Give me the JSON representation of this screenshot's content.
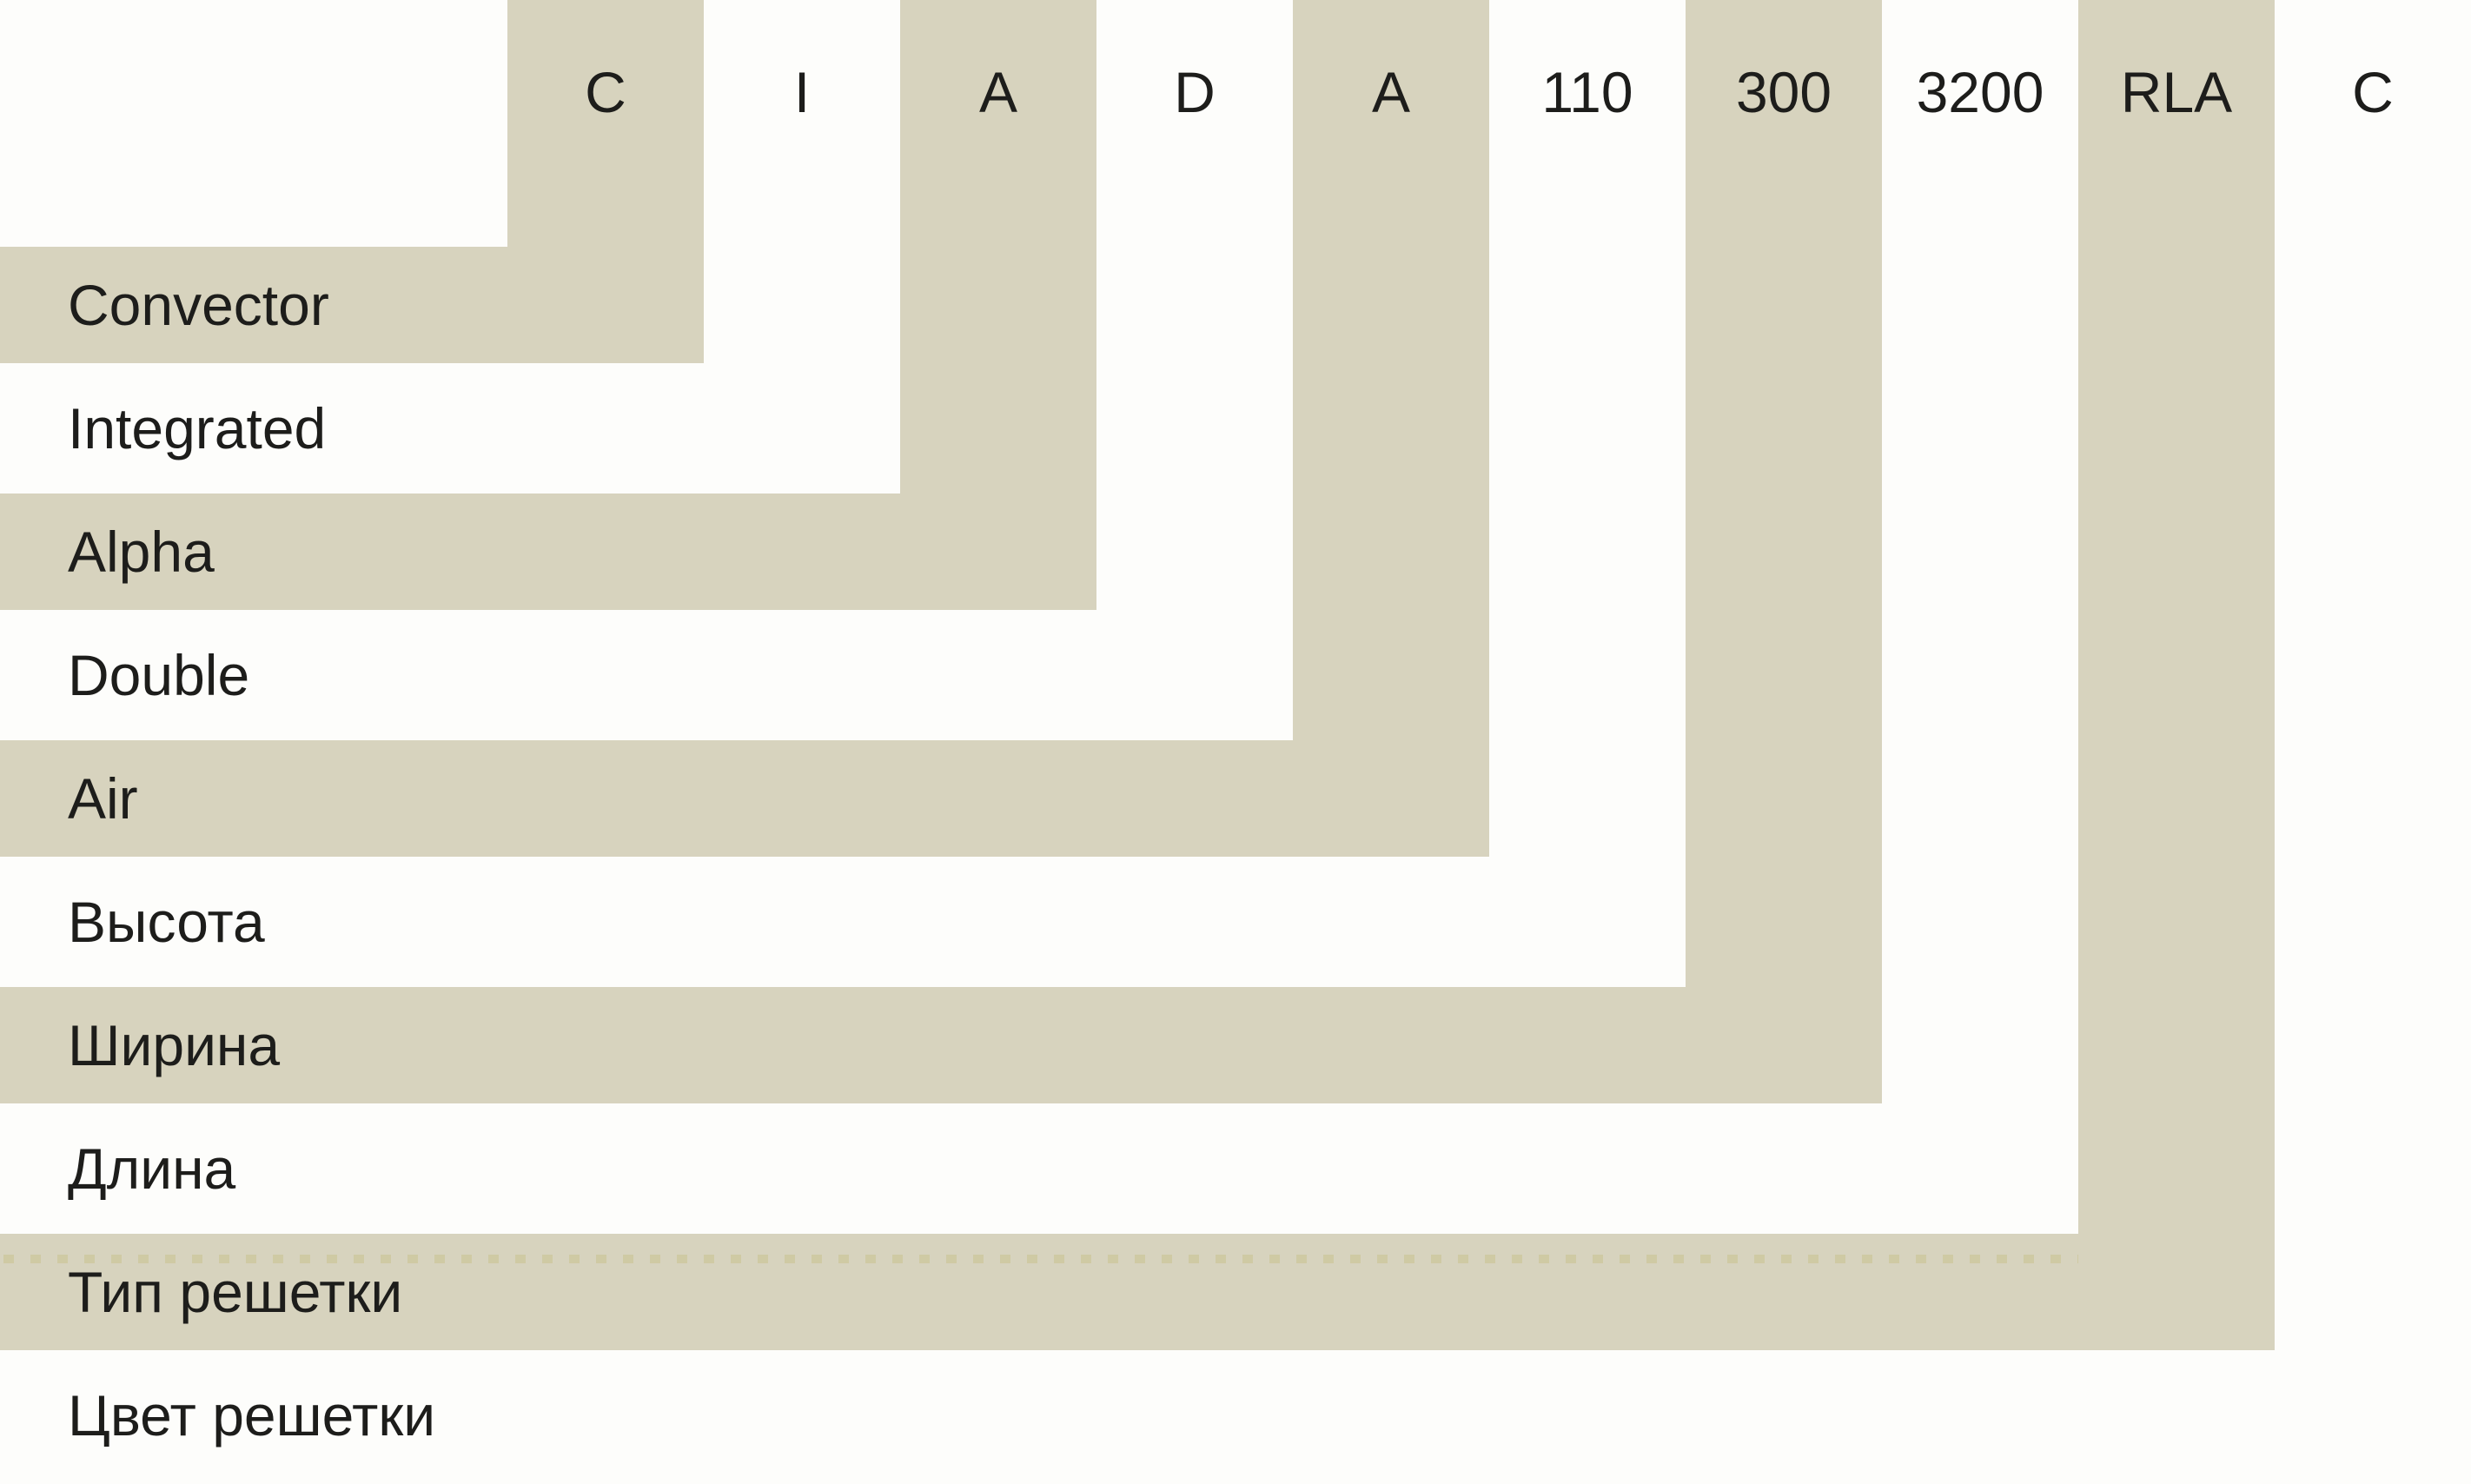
{
  "diagram": {
    "type": "nomenclature-decoder",
    "segments": [
      {
        "code": "C",
        "label": "Convector",
        "shaded": true,
        "dotted_line": false
      },
      {
        "code": "I",
        "label": "Integrated",
        "shaded": false,
        "dotted_line": false
      },
      {
        "code": "A",
        "label": "Alpha",
        "shaded": true,
        "dotted_line": false
      },
      {
        "code": "D",
        "label": "Double",
        "shaded": false,
        "dotted_line": false
      },
      {
        "code": "A",
        "label": "Air",
        "shaded": true,
        "dotted_line": false
      },
      {
        "code": "110",
        "label": "Высота",
        "shaded": false,
        "dotted_line": false
      },
      {
        "code": "300",
        "label": "Ширина",
        "shaded": true,
        "dotted_line": false
      },
      {
        "code": "3200",
        "label": "Длина",
        "shaded": false,
        "dotted_line": false
      },
      {
        "code": "RLA",
        "label": "Тип решетки",
        "shaded": true,
        "dotted_line": true
      },
      {
        "code": "C",
        "label": "Цвет решетки",
        "shaded": false,
        "dotted_line": false
      }
    ]
  },
  "colors": {
    "background": "#fdfdfb",
    "band": "#d7d3be",
    "dash": "#cfcaa4",
    "text": "#1d1d1b"
  }
}
